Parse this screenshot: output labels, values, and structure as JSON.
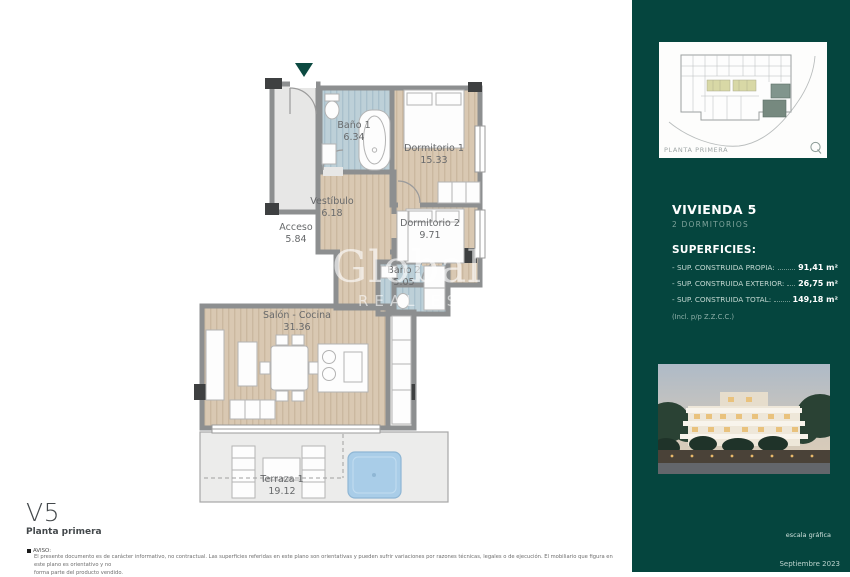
{
  "plan": {
    "rooms": [
      {
        "name": "Acceso",
        "area": "5.84"
      },
      {
        "name": "Baño 1",
        "area": "6.34"
      },
      {
        "name": "Dormitorio 1",
        "area": "15.33"
      },
      {
        "name": "Vestíbulo",
        "area": "6.18"
      },
      {
        "name": "Dormitorio 2",
        "area": "9.71"
      },
      {
        "name": "Baño 2",
        "area": "5.05"
      },
      {
        "name": "Salón - Cocina",
        "area": "31.36"
      },
      {
        "name": "Terraza 1",
        "area": "19.12"
      }
    ],
    "watermark": {
      "line1": "GlobalS",
      "line2": "REAL ESTATE"
    },
    "icons": {
      "entrance_marker": "triangle-down",
      "logo": "q-circle"
    }
  },
  "footer": {
    "unit": "V5",
    "floor": "Planta primera",
    "notice_label": "AVISO:",
    "notice_line1": "El presente documento es de carácter informativo, no contractual. Las superficies referidas en este plano son orientativas y pueden sufrir variaciones por razones técnicas, legales o de ejecución. El mobiliario que figura en este plano es orientativo y no",
    "notice_line2": "forma parte del producto vendido."
  },
  "sidebar": {
    "thumbnail_caption": "PLANTA PRIMERA",
    "unit_title": "VIVIENDA 5",
    "unit_subtitle": "2 DORMITORIOS",
    "surfaces_title": "SUPERFICIES:",
    "surfaces": [
      {
        "label": "- SUP. CONSTRUIDA PROPIA:",
        "value": "91,41 m²"
      },
      {
        "label": "- SUP. CONSTRUIDA EXTERIOR:",
        "value": "26,75 m²"
      },
      {
        "label": "- SUP. CONSTRUIDA TOTAL:",
        "value": "149,18 m²"
      }
    ],
    "surfaces_note": "(Incl. p/p Z.Z.C.C.)",
    "scale_label": "escala gráfica",
    "scale_ticks": [
      "0",
      "1",
      "2",
      "3",
      "4"
    ],
    "date": "Septiembre 2023"
  },
  "colors": {
    "sidebar_bg": "#05453e",
    "accent_teal": "#0c4a41",
    "wood_floor": "#d9c8b2",
    "bath_floor": "#b9cdd7",
    "terrace_floor": "#ececeb",
    "pool_blue": "#a9cde8",
    "wall_gray": "#8d8f90",
    "highlight_unit": "#76897f"
  }
}
